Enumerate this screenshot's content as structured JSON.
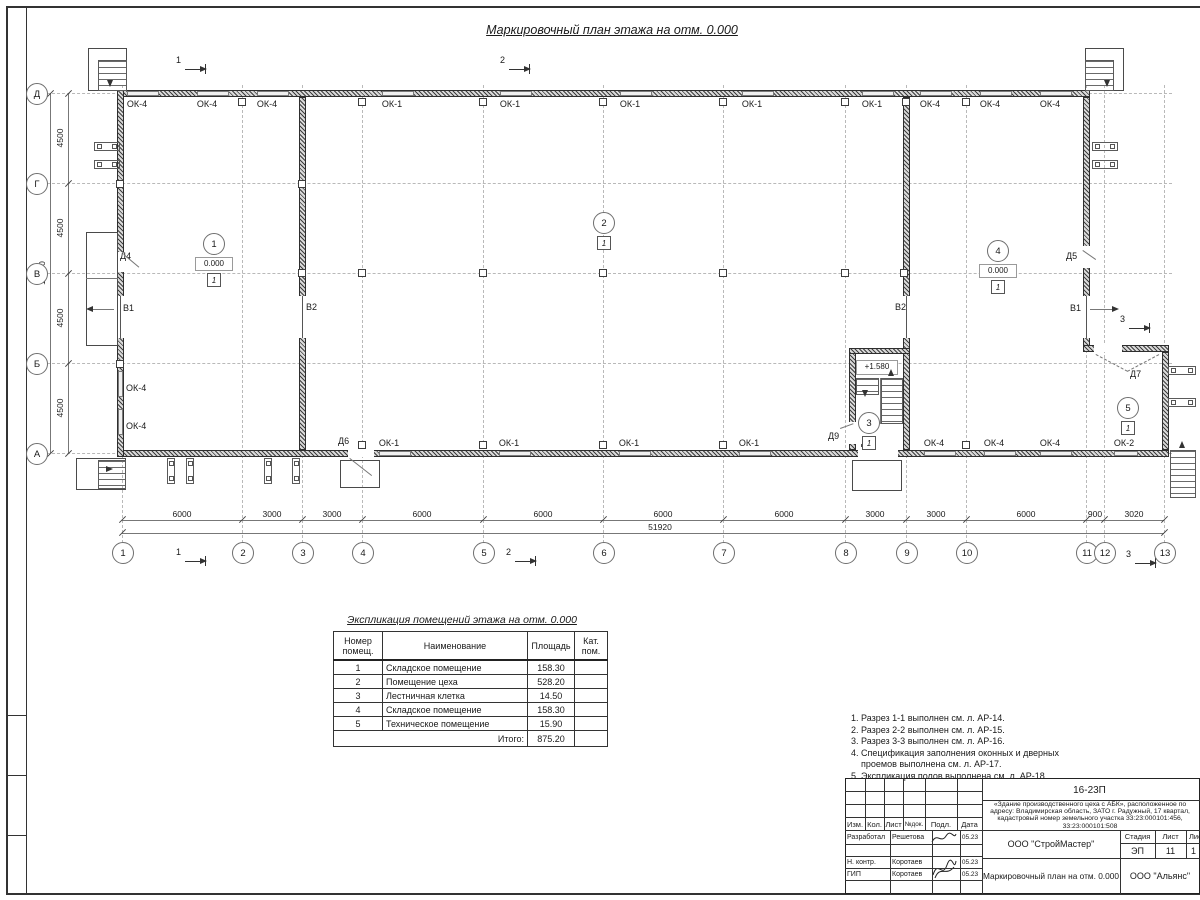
{
  "page_title": "Маркировочный план этажа на отм. 0.000",
  "plan": {
    "axes_bottom": [
      "1",
      "2",
      "3",
      "4",
      "5",
      "6",
      "7",
      "8",
      "9",
      "10",
      "11",
      "12",
      "13"
    ],
    "axes_left": [
      "Д",
      "Г",
      "В",
      "Б",
      "А"
    ],
    "dims_bottom": [
      "6000",
      "3000",
      "3000",
      "6000",
      "6000",
      "6000",
      "6000",
      "3000",
      "3000",
      "6000",
      "900",
      "3020"
    ],
    "dim_bottom_total": "51920",
    "dims_left": [
      "4500",
      "4500",
      "4500",
      "4500"
    ],
    "dim_left_total": "18000",
    "windows_top": [
      "ОК-4",
      "ОК-4",
      "ОК-4",
      "ОК-1",
      "ОК-1",
      "ОК-1",
      "ОК-1",
      "ОК-1",
      "ОК-4",
      "ОК-4",
      "ОК-4"
    ],
    "windows_bottom": [
      "ОК-1",
      "ОК-1",
      "ОК-1",
      "ОК-1",
      "ОК-4",
      "ОК-4",
      "ОК-4",
      "ОК-2"
    ],
    "windows_left": [
      "ОК-4",
      "ОК-4"
    ],
    "door_labels": [
      "Д4",
      "Д5",
      "Д6",
      "Д7",
      "Д9",
      "Д1"
    ],
    "gate_labels": [
      "В1",
      "В2",
      "В2",
      "В1"
    ],
    "section_labels": [
      "1",
      "2",
      "1",
      "2",
      "3",
      "3"
    ],
    "rooms": [
      {
        "number": "1",
        "elevation": "0.000",
        "floor_mark": "1"
      },
      {
        "number": "2",
        "floor_mark": "1"
      },
      {
        "number": "3",
        "floor_mark": "1"
      },
      {
        "number": "4",
        "elevation": "0.000",
        "floor_mark": "1"
      },
      {
        "number": "5",
        "floor_mark": "1"
      }
    ],
    "stair_landing_elevation": "+1.580"
  },
  "explication": {
    "title": "Экспликация помещений этажа на отм. 0.000",
    "headers": [
      "Номер помещ.",
      "Наименование",
      "Площадь",
      "Кат. пом."
    ],
    "rows": [
      [
        "1",
        "Складское помещение",
        "158.30",
        ""
      ],
      [
        "2",
        "Помещение цеха",
        "528.20",
        ""
      ],
      [
        "3",
        "Лестничная клетка",
        "14.50",
        ""
      ],
      [
        "4",
        "Складское помещение",
        "158.30",
        ""
      ],
      [
        "5",
        "Техническое помещение",
        "15.90",
        ""
      ]
    ],
    "total_label": "Итого:",
    "total_value": "875.20"
  },
  "notes": {
    "lines": [
      "1. Разрез 1-1 выполнен см. л. АР-14.",
      "2. Разрез 2-2 выполнен см. л. АР-15.",
      "3. Разрез 3-3 выполнен см. л. АР-16.",
      "4. Спецификация заполнения оконных и дверных",
      "    проемов выполнена см. л. АР-17.",
      "5. Экспликация полов выполнена см. л. АР-18."
    ]
  },
  "titleblock": {
    "document_code": "16-23П",
    "object_description": "«Здание производственного цеха с АБК», расположенное по адресу: Владимирская область, ЗАТО г. Радужный, 17 квартал, кадастровый номер земельного участка 33:23:000101:456, 33:23:000101:508",
    "columns": [
      "Изм.",
      "Кол.",
      "Лист",
      "№док.",
      "Подл.",
      "Дата"
    ],
    "signature_rows": [
      {
        "role": "Разработал",
        "name": "Решетова",
        "date": "05.23"
      },
      {
        "role": "Н. контр.",
        "name": "Коротаев",
        "date": "05.23"
      },
      {
        "role": "ГИП",
        "name": "Коротаев",
        "date": "05.23"
      }
    ],
    "organization": "ООО \"СтройМастер\"",
    "stage_headers": [
      "Стадия",
      "Лист",
      "Листов"
    ],
    "stage_values": [
      "ЭП",
      "11",
      "1"
    ],
    "sheet_title": "Маркировочный план на отм. 0.000",
    "company": "ООО \"Альянс\""
  }
}
